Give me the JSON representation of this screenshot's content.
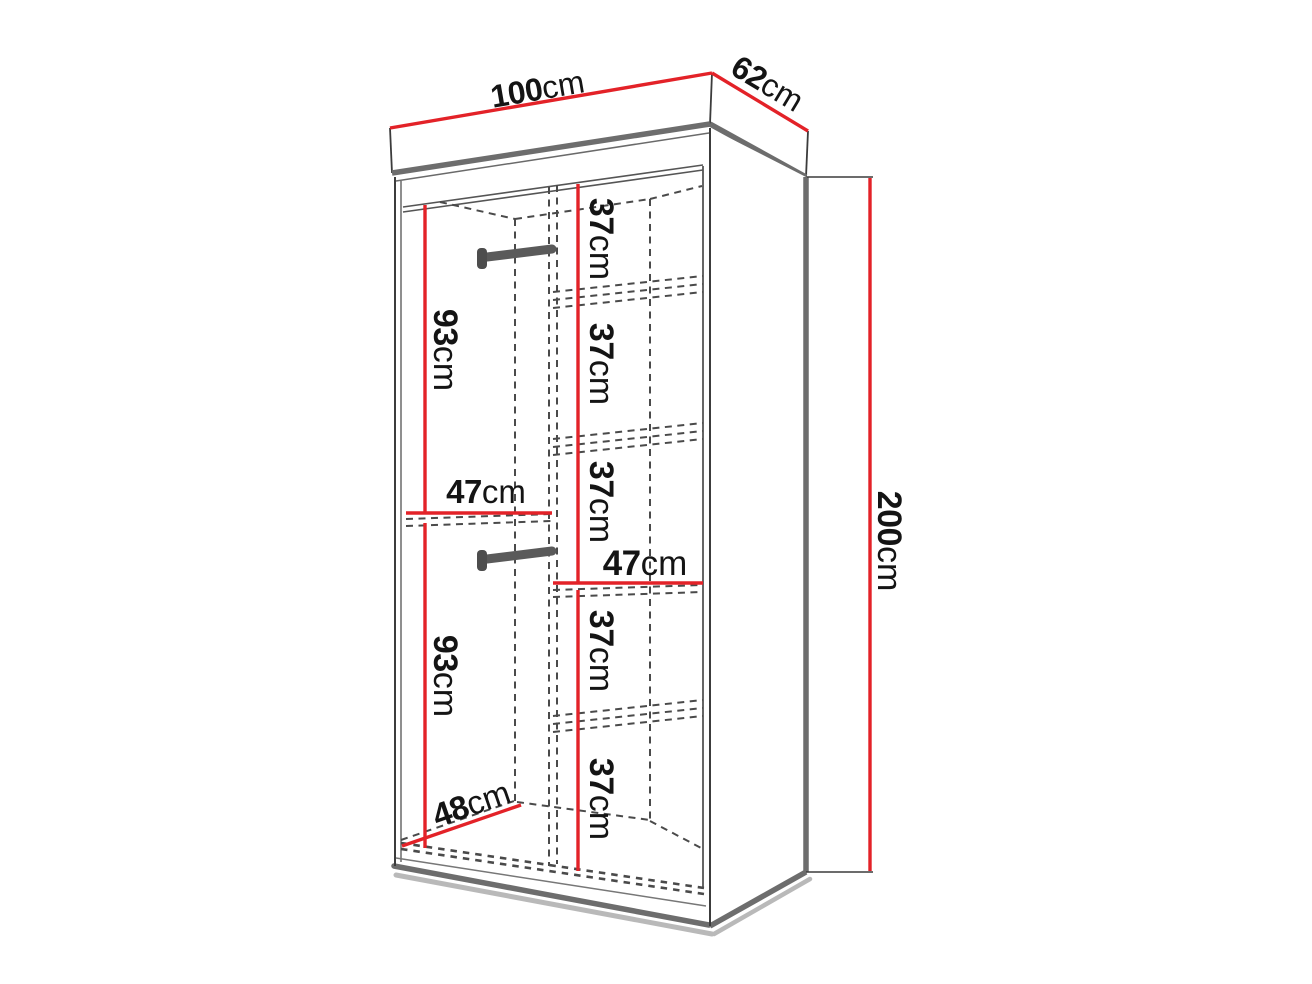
{
  "diagram": {
    "kind": "wardrobe-dimension-diagram",
    "object": "two-section open wardrobe with hanging rails and shelves",
    "background": "#ffffff"
  },
  "colors": {
    "dimension_line": "#e32228",
    "outline_thin": "#3c3c3c",
    "panel_edge_thick": "#6d6d6d",
    "dashed_line": "#4a4a4a",
    "rod": "#5a5a5a",
    "shadow": "#b9b9b9",
    "text": "#141414"
  },
  "labels": {
    "width": {
      "value": "100",
      "unit": "cm"
    },
    "depth": {
      "value": "62",
      "unit": "cm"
    },
    "height": {
      "value": "200",
      "unit": "cm"
    },
    "hanging_upper_height": {
      "value": "93",
      "unit": "cm"
    },
    "hanging_lower_height": {
      "value": "93",
      "unit": "cm"
    },
    "left_section_width": {
      "value": "47",
      "unit": "cm"
    },
    "right_section_width": {
      "value": "47",
      "unit": "cm"
    },
    "interior_floor_depth": {
      "value": "48",
      "unit": "cm"
    },
    "shelf_spacings": [
      {
        "value": "37",
        "unit": "cm"
      },
      {
        "value": "37",
        "unit": "cm"
      },
      {
        "value": "37",
        "unit": "cm"
      },
      {
        "value": "37",
        "unit": "cm"
      },
      {
        "value": "37",
        "unit": "cm"
      }
    ]
  }
}
